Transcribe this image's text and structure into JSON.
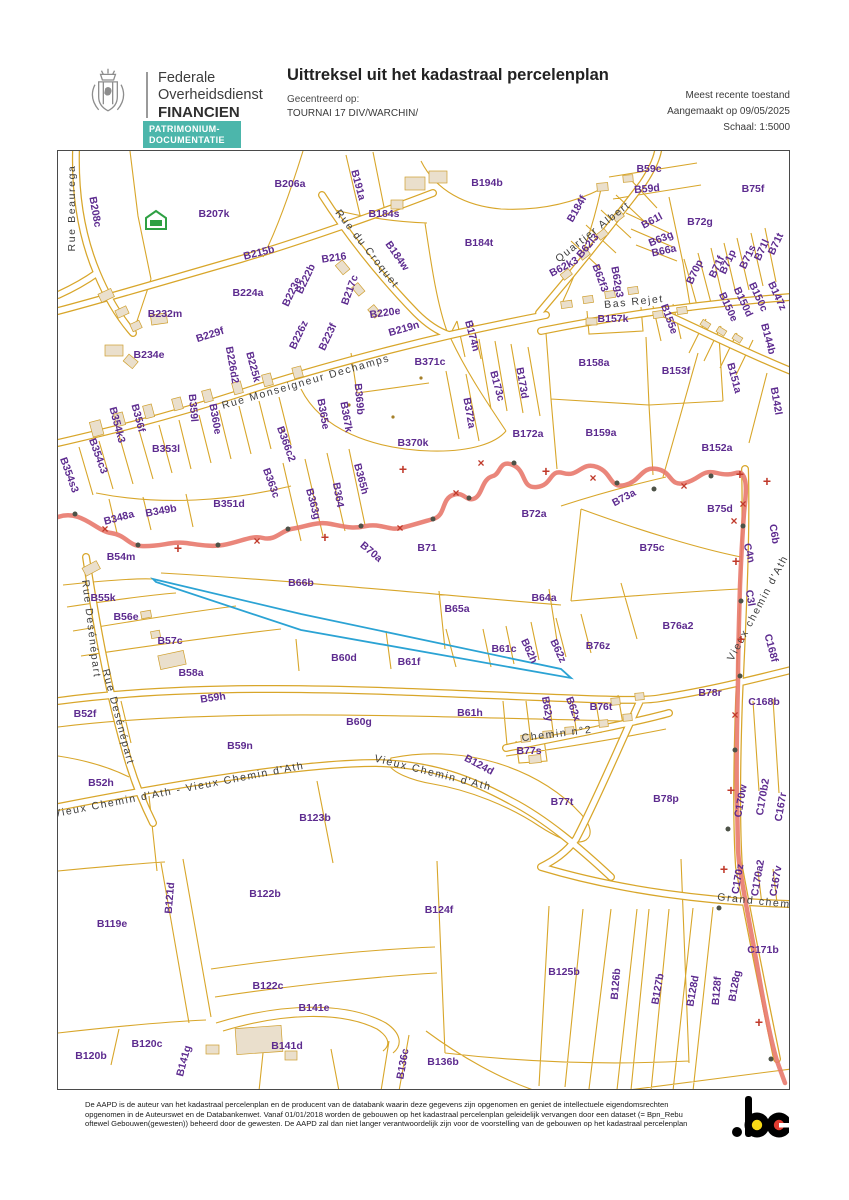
{
  "header": {
    "org": [
      "Federale",
      "Overheidsdienst",
      "FINANCIEN"
    ],
    "badge": [
      "PATRIMONIUM-",
      "DOCUMENTATIE"
    ],
    "title": "Uittreksel uit het kadastraal percelenplan",
    "centered_label": "Gecentreerd op:",
    "centered_value": "TOURNAI 17 DIV/WARCHIN/",
    "meta": [
      "Meest recente toestand",
      "Aangemaakt op 09/05/2025",
      "Schaal: 1:5000"
    ]
  },
  "map": {
    "colors": {
      "parcel_line": "#d8a62a",
      "parcel_label": "#5d2b8f",
      "street_label": "#3d3d3d",
      "municipal_boundary": "#e8796d",
      "boundary_marks": "#c03a2b",
      "selected_parcel": "#2ba3d4",
      "building_fill": "#eadfcc",
      "centered_marker_green": "#2ea043"
    },
    "parcels": [
      {
        "t": "B208c",
        "x": 94,
        "y": 211,
        "r": 80
      },
      {
        "t": "B206a",
        "x": 289,
        "y": 183,
        "r": 0
      },
      {
        "t": "B207k",
        "x": 213,
        "y": 213,
        "r": 0
      },
      {
        "t": "B191a",
        "x": 357,
        "y": 184,
        "r": 75
      },
      {
        "t": "B194b",
        "x": 486,
        "y": 182,
        "r": 0
      },
      {
        "t": "B184s",
        "x": 383,
        "y": 213,
        "r": 0
      },
      {
        "t": "B184w",
        "x": 396,
        "y": 255,
        "r": 55
      },
      {
        "t": "B184t",
        "x": 478,
        "y": 242,
        "r": 0
      },
      {
        "t": "B184f",
        "x": 576,
        "y": 208,
        "r": -60
      },
      {
        "t": "B215b",
        "x": 258,
        "y": 252,
        "r": -14
      },
      {
        "t": "B216",
        "x": 333,
        "y": 257,
        "r": -8
      },
      {
        "t": "B217c",
        "x": 349,
        "y": 289,
        "r": -70
      },
      {
        "t": "B222b",
        "x": 305,
        "y": 278,
        "r": -65
      },
      {
        "t": "B223e",
        "x": 291,
        "y": 291,
        "r": -65
      },
      {
        "t": "B224a",
        "x": 247,
        "y": 292,
        "r": 0
      },
      {
        "t": "B220e",
        "x": 384,
        "y": 312,
        "r": -8
      },
      {
        "t": "B219n",
        "x": 403,
        "y": 328,
        "r": -16
      },
      {
        "t": "B223f",
        "x": 327,
        "y": 336,
        "r": -65
      },
      {
        "t": "B226z",
        "x": 298,
        "y": 334,
        "r": -65
      },
      {
        "t": "B229f",
        "x": 209,
        "y": 334,
        "r": -18
      },
      {
        "t": "B232m",
        "x": 164,
        "y": 313,
        "r": 0
      },
      {
        "t": "B234e",
        "x": 148,
        "y": 354,
        "r": 0
      },
      {
        "t": "B226d2",
        "x": 231,
        "y": 364,
        "r": 80
      },
      {
        "t": "B225k",
        "x": 252,
        "y": 366,
        "r": 75
      },
      {
        "t": "B59c",
        "x": 648,
        "y": 168,
        "r": 0
      },
      {
        "t": "B59d",
        "x": 646,
        "y": 188,
        "r": -5
      },
      {
        "t": "B75f",
        "x": 752,
        "y": 188,
        "r": 0
      },
      {
        "t": "B61l",
        "x": 651,
        "y": 220,
        "r": -28
      },
      {
        "t": "B72g",
        "x": 699,
        "y": 221,
        "r": 0
      },
      {
        "t": "B63g",
        "x": 660,
        "y": 238,
        "r": -22
      },
      {
        "t": "B66a",
        "x": 663,
        "y": 250,
        "r": -12
      },
      {
        "t": "B62l3",
        "x": 587,
        "y": 245,
        "r": -50
      },
      {
        "t": "B62k3",
        "x": 563,
        "y": 266,
        "r": -28
      },
      {
        "t": "B62f3",
        "x": 599,
        "y": 277,
        "r": 70
      },
      {
        "t": "B62g3",
        "x": 616,
        "y": 281,
        "r": 80
      },
      {
        "t": "B70p",
        "x": 694,
        "y": 271,
        "r": -65
      },
      {
        "t": "B71f",
        "x": 716,
        "y": 266,
        "r": -65
      },
      {
        "t": "B71p",
        "x": 727,
        "y": 261,
        "r": -65
      },
      {
        "t": "B71s",
        "x": 747,
        "y": 256,
        "r": -65
      },
      {
        "t": "B71l",
        "x": 761,
        "y": 249,
        "r": -65
      },
      {
        "t": "B71t",
        "x": 775,
        "y": 243,
        "r": -65
      },
      {
        "t": "B157k",
        "x": 612,
        "y": 318,
        "r": 0
      },
      {
        "t": "B155e",
        "x": 668,
        "y": 318,
        "r": 70
      },
      {
        "t": "B150e",
        "x": 727,
        "y": 306,
        "r": 65
      },
      {
        "t": "B150d",
        "x": 742,
        "y": 301,
        "r": 65
      },
      {
        "t": "B150c",
        "x": 757,
        "y": 296,
        "r": 65
      },
      {
        "t": "B147z",
        "x": 776,
        "y": 295,
        "r": 65
      },
      {
        "t": "B144b",
        "x": 767,
        "y": 338,
        "r": 75
      },
      {
        "t": "B174n",
        "x": 471,
        "y": 335,
        "r": 75
      },
      {
        "t": "B371c",
        "x": 429,
        "y": 361,
        "r": 0
      },
      {
        "t": "B158a",
        "x": 593,
        "y": 362,
        "r": 0
      },
      {
        "t": "B153f",
        "x": 675,
        "y": 370,
        "r": 0
      },
      {
        "t": "B151a",
        "x": 733,
        "y": 377,
        "r": 75
      },
      {
        "t": "B142l",
        "x": 775,
        "y": 400,
        "r": 80
      },
      {
        "t": "B173c",
        "x": 496,
        "y": 385,
        "r": 75
      },
      {
        "t": "B173d",
        "x": 521,
        "y": 382,
        "r": 80
      },
      {
        "t": "B372a",
        "x": 468,
        "y": 412,
        "r": 80
      },
      {
        "t": "B172a",
        "x": 527,
        "y": 433,
        "r": 0
      },
      {
        "t": "B370k",
        "x": 412,
        "y": 442,
        "r": 0
      },
      {
        "t": "B369b",
        "x": 358,
        "y": 398,
        "r": 85
      },
      {
        "t": "B367k",
        "x": 345,
        "y": 416,
        "r": 80
      },
      {
        "t": "B365e",
        "x": 322,
        "y": 413,
        "r": 80
      },
      {
        "t": "B366c2",
        "x": 285,
        "y": 443,
        "r": 70
      },
      {
        "t": "B359l",
        "x": 192,
        "y": 407,
        "r": 85
      },
      {
        "t": "B360e",
        "x": 214,
        "y": 418,
        "r": 80
      },
      {
        "t": "B356f",
        "x": 137,
        "y": 417,
        "r": 75
      },
      {
        "t": "B354k3",
        "x": 116,
        "y": 424,
        "r": 75
      },
      {
        "t": "B354c3",
        "x": 97,
        "y": 455,
        "r": 70
      },
      {
        "t": "B354s3",
        "x": 68,
        "y": 474,
        "r": 70
      },
      {
        "t": "B353l",
        "x": 165,
        "y": 448,
        "r": 0
      },
      {
        "t": "B363c",
        "x": 270,
        "y": 482,
        "r": 70
      },
      {
        "t": "B363g",
        "x": 312,
        "y": 503,
        "r": 75
      },
      {
        "t": "B364",
        "x": 337,
        "y": 494,
        "r": 80
      },
      {
        "t": "B365h",
        "x": 360,
        "y": 478,
        "r": 75
      },
      {
        "t": "B159a",
        "x": 600,
        "y": 432,
        "r": 0
      },
      {
        "t": "B152a",
        "x": 716,
        "y": 447,
        "r": 0
      },
      {
        "t": "B348a",
        "x": 118,
        "y": 517,
        "r": -15
      },
      {
        "t": "B349b",
        "x": 160,
        "y": 510,
        "r": -10
      },
      {
        "t": "B351d",
        "x": 228,
        "y": 503,
        "r": 0
      },
      {
        "t": "B54m",
        "x": 120,
        "y": 556,
        "r": 0
      },
      {
        "t": "B73a",
        "x": 623,
        "y": 497,
        "r": -28
      },
      {
        "t": "B75d",
        "x": 719,
        "y": 508,
        "r": 0
      },
      {
        "t": "B72a",
        "x": 533,
        "y": 513,
        "r": 0
      },
      {
        "t": "B70a",
        "x": 370,
        "y": 551,
        "r": 40
      },
      {
        "t": "B71",
        "x": 426,
        "y": 547,
        "r": 0
      },
      {
        "t": "B75c",
        "x": 651,
        "y": 547,
        "r": 0
      },
      {
        "t": "C6b",
        "x": 773,
        "y": 533,
        "r": 80
      },
      {
        "t": "C4n",
        "x": 748,
        "y": 552,
        "r": 75
      },
      {
        "t": "B66b",
        "x": 300,
        "y": 582,
        "r": 0
      },
      {
        "t": "B55k",
        "x": 102,
        "y": 597,
        "r": 0
      },
      {
        "t": "B56e",
        "x": 125,
        "y": 616,
        "r": 0
      },
      {
        "t": "B65a",
        "x": 456,
        "y": 608,
        "r": 0
      },
      {
        "t": "B64a",
        "x": 543,
        "y": 597,
        "r": 0
      },
      {
        "t": "C3l",
        "x": 749,
        "y": 597,
        "r": 80
      },
      {
        "t": "B57c",
        "x": 169,
        "y": 640,
        "r": 0
      },
      {
        "t": "B76a2",
        "x": 677,
        "y": 625,
        "r": 0
      },
      {
        "t": "B76z",
        "x": 597,
        "y": 645,
        "r": 0
      },
      {
        "t": "B62z",
        "x": 557,
        "y": 650,
        "r": 65
      },
      {
        "t": "B62h",
        "x": 528,
        "y": 650,
        "r": 65
      },
      {
        "t": "B61c",
        "x": 503,
        "y": 648,
        "r": 0
      },
      {
        "t": "B61f",
        "x": 408,
        "y": 661,
        "r": 0
      },
      {
        "t": "B60d",
        "x": 343,
        "y": 657,
        "r": 0
      },
      {
        "t": "B58a",
        "x": 190,
        "y": 672,
        "r": 0
      },
      {
        "t": "C168f",
        "x": 770,
        "y": 647,
        "r": 75
      },
      {
        "t": "B59h",
        "x": 212,
        "y": 697,
        "r": -8
      },
      {
        "t": "B52f",
        "x": 84,
        "y": 713,
        "r": 0
      },
      {
        "t": "B78r",
        "x": 709,
        "y": 692,
        "r": 0
      },
      {
        "t": "C168b",
        "x": 763,
        "y": 701,
        "r": 0
      },
      {
        "t": "B59n",
        "x": 239,
        "y": 745,
        "r": 0
      },
      {
        "t": "B76t",
        "x": 600,
        "y": 706,
        "r": 0
      },
      {
        "t": "B62x",
        "x": 572,
        "y": 708,
        "r": 70
      },
      {
        "t": "B62y",
        "x": 546,
        "y": 708,
        "r": 80
      },
      {
        "t": "B61h",
        "x": 469,
        "y": 712,
        "r": 0
      },
      {
        "t": "B60g",
        "x": 358,
        "y": 721,
        "r": 0
      },
      {
        "t": "B77s",
        "x": 528,
        "y": 750,
        "r": 0
      },
      {
        "t": "B124d",
        "x": 478,
        "y": 764,
        "r": 28
      },
      {
        "t": "B52h",
        "x": 100,
        "y": 782,
        "r": 0
      },
      {
        "t": "B77t",
        "x": 561,
        "y": 801,
        "r": 0
      },
      {
        "t": "B78p",
        "x": 665,
        "y": 798,
        "r": 0
      },
      {
        "t": "C170w",
        "x": 740,
        "y": 800,
        "r": -80
      },
      {
        "t": "C170b2",
        "x": 762,
        "y": 796,
        "r": -80
      },
      {
        "t": "C167r",
        "x": 780,
        "y": 806,
        "r": -80
      },
      {
        "t": "B123b",
        "x": 314,
        "y": 817,
        "r": 0
      },
      {
        "t": "B122b",
        "x": 264,
        "y": 893,
        "r": 0
      },
      {
        "t": "B121d",
        "x": 169,
        "y": 897,
        "r": -85
      },
      {
        "t": "B119e",
        "x": 111,
        "y": 923,
        "r": 0
      },
      {
        "t": "B124f",
        "x": 438,
        "y": 909,
        "r": 0
      },
      {
        "t": "C170z",
        "x": 737,
        "y": 878,
        "r": -80
      },
      {
        "t": "C170a2",
        "x": 757,
        "y": 877,
        "r": -80
      },
      {
        "t": "C167v",
        "x": 775,
        "y": 880,
        "r": -80
      },
      {
        "t": "C171b",
        "x": 762,
        "y": 949,
        "r": 0
      },
      {
        "t": "B122c",
        "x": 267,
        "y": 985,
        "r": 0
      },
      {
        "t": "B125b",
        "x": 563,
        "y": 971,
        "r": 0
      },
      {
        "t": "B126b",
        "x": 615,
        "y": 983,
        "r": -85
      },
      {
        "t": "B127b",
        "x": 657,
        "y": 988,
        "r": -80
      },
      {
        "t": "B128d",
        "x": 692,
        "y": 990,
        "r": -80
      },
      {
        "t": "B128f",
        "x": 716,
        "y": 990,
        "r": -85
      },
      {
        "t": "B128g",
        "x": 734,
        "y": 985,
        "r": -80
      },
      {
        "t": "B141e",
        "x": 313,
        "y": 1007,
        "r": 0
      },
      {
        "t": "B141d",
        "x": 286,
        "y": 1045,
        "r": 0
      },
      {
        "t": "B120c",
        "x": 146,
        "y": 1043,
        "r": 0
      },
      {
        "t": "B120b",
        "x": 90,
        "y": 1055,
        "r": 0
      },
      {
        "t": "B141g",
        "x": 183,
        "y": 1060,
        "r": -75
      },
      {
        "t": "B136c",
        "x": 402,
        "y": 1063,
        "r": -80
      },
      {
        "t": "B136b",
        "x": 442,
        "y": 1061,
        "r": 0
      }
    ],
    "streets": [
      {
        "t": "Rue Beaurega",
        "x": 71,
        "y": 207,
        "r": -90
      },
      {
        "t": "Rue du Croquet",
        "x": 366,
        "y": 248,
        "r": 52
      },
      {
        "t": "Quartier Albert",
        "x": 592,
        "y": 231,
        "r": -38
      },
      {
        "t": "Bas Rejet",
        "x": 633,
        "y": 301,
        "r": -6
      },
      {
        "t": "Rue Monseigneur Dechamps",
        "x": 305,
        "y": 381,
        "r": -16
      },
      {
        "t": "Rue Desénépart",
        "x": 90,
        "y": 628,
        "r": 83
      },
      {
        "t": "Rue Desénépart",
        "x": 117,
        "y": 716,
        "r": 75
      },
      {
        "t": "Vieux Chemin d'Ath - Vieux Chemin d'Ath",
        "x": 178,
        "y": 789,
        "r": -11
      },
      {
        "t": "Vieux Chemin d'Ath",
        "x": 432,
        "y": 772,
        "r": 14
      },
      {
        "t": "Chemin n°2",
        "x": 556,
        "y": 733,
        "r": -7
      },
      {
        "t": "Vieux chemin d'Ath",
        "x": 757,
        "y": 607,
        "r": -62
      },
      {
        "t": "Grand chem",
        "x": 753,
        "y": 900,
        "r": 6
      }
    ],
    "markers": {
      "dots": [
        [
          74,
          513
        ],
        [
          137,
          544
        ],
        [
          217,
          544
        ],
        [
          287,
          528
        ],
        [
          360,
          525
        ],
        [
          432,
          518
        ],
        [
          468,
          497
        ],
        [
          513,
          462
        ],
        [
          616,
          482
        ],
        [
          653,
          488
        ],
        [
          710,
          475
        ],
        [
          742,
          525
        ],
        [
          740,
          600
        ],
        [
          739,
          675
        ],
        [
          734,
          749
        ],
        [
          727,
          828
        ],
        [
          718,
          907
        ],
        [
          770,
          1058
        ]
      ],
      "crosses": [
        [
          104,
          528
        ],
        [
          256,
          540
        ],
        [
          399,
          527
        ],
        [
          455,
          492
        ],
        [
          480,
          462
        ],
        [
          592,
          477
        ],
        [
          683,
          485
        ],
        [
          733,
          520
        ],
        [
          742,
          503
        ],
        [
          734,
          714
        ]
      ],
      "plusses": [
        [
          177,
          547
        ],
        [
          324,
          536
        ],
        [
          402,
          468
        ],
        [
          545,
          470
        ],
        [
          739,
          473
        ],
        [
          766,
          480
        ],
        [
          735,
          560
        ],
        [
          740,
          638
        ],
        [
          730,
          789
        ],
        [
          723,
          868
        ],
        [
          758,
          1021
        ]
      ]
    }
  },
  "footer": {
    "disclaimer": "De AAPD is de auteur van het kadastraal percelenplan en de producent van de databank waarin deze gegevens zijn opgenomen en geniet de intellectuele eigendomsrechten opgenomen in de Auteurswet en de Databankenwet. Vanaf 01/01/2018 worden de gebouwen op het kadastraal percelenplan geleidelijk vervangen door een dataset (= Bpn_Rebu oftewel Gebouwen(gewesten)) beheerd door de gewesten. De AAPD zal dan niet langer verantwoordelijk zijn voor de voorstelling van de gebouwen op het kadastraal percelenplan",
    "country_logo": ".be"
  }
}
